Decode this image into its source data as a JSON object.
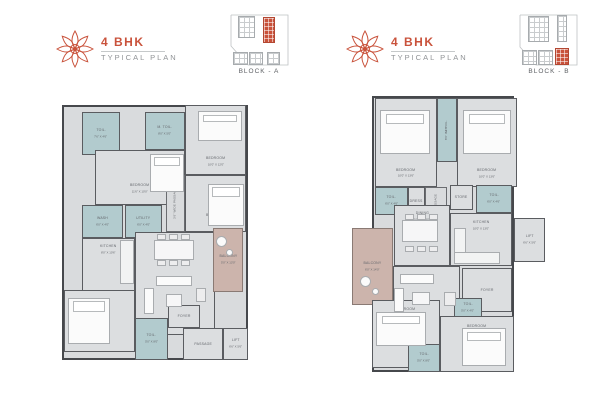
{
  "colors": {
    "accent": "#c9523b",
    "wall": "#46484c",
    "floor": "#d9dbdd",
    "toilet": "#b2cbce",
    "balcony": "#ccb4ac",
    "label": "#63666b"
  },
  "headers": [
    {
      "title": "4 BHK",
      "subtitle": "TYPICAL PLAN",
      "block_label": "BLOCK - A"
    },
    {
      "title": "4 BHK",
      "subtitle": "TYPICAL PLAN",
      "block_label": "BLOCK - B"
    }
  ],
  "keyplans": [
    {
      "outline_points": "3,1 60,1 60,51 20,51 3,32 3,1",
      "buildings": [
        {
          "x": 10,
          "y": 2,
          "w": 17,
          "h": 22,
          "hl": false
        },
        {
          "x": 35,
          "y": 3,
          "w": 12,
          "h": 26,
          "hl": true
        },
        {
          "x": 5,
          "y": 38,
          "w": 15,
          "h": 13,
          "hl": false
        },
        {
          "x": 21,
          "y": 38,
          "w": 14,
          "h": 13,
          "hl": false
        },
        {
          "x": 39,
          "y": 38,
          "w": 13,
          "h": 13,
          "hl": false
        }
      ]
    },
    {
      "outline_points": "2,1 59,1 59,51 18,51 2,33 2,1",
      "buildings": [
        {
          "x": 10,
          "y": 2,
          "w": 21,
          "h": 26,
          "hl": false
        },
        {
          "x": 39,
          "y": 1,
          "w": 10,
          "h": 27,
          "hl": false
        },
        {
          "x": 4,
          "y": 36,
          "w": 15,
          "h": 15,
          "hl": false
        },
        {
          "x": 20,
          "y": 36,
          "w": 15,
          "h": 15,
          "hl": false
        },
        {
          "x": 37,
          "y": 34,
          "w": 14,
          "h": 17,
          "hl": true
        }
      ]
    }
  ],
  "plans": [
    {
      "name": "block-a-unit-plan",
      "outline": {
        "x": 4,
        "y": 13,
        "w": 186,
        "h": 255
      },
      "rooms": [
        {
          "label": "TOIL.",
          "dim": "7'6\" X 4'6\"",
          "type": "toilet",
          "x": 24,
          "y": 20,
          "w": 38,
          "h": 43
        },
        {
          "label": "M. TOIL.",
          "dim": "8'0\" X 5'0\"",
          "type": "toilet",
          "x": 87,
          "y": 20,
          "w": 40,
          "h": 38
        },
        {
          "label": "BEDROOM",
          "dim": "11'6\" X 10'0\"",
          "x": 37,
          "y": 58,
          "w": 90,
          "h": 55,
          "va": "bottom"
        },
        {
          "label": "BEDROOM",
          "dim": "10'0\" X 12'0\"",
          "x": 127,
          "y": 13,
          "w": 61,
          "h": 70,
          "va": "bottom"
        },
        {
          "label": "BEDROOM",
          "dim": "10'0\" X 11'6\"",
          "x": 127,
          "y": 83,
          "w": 61,
          "h": 57,
          "va": "bottom"
        },
        {
          "label": "3'6\" WIDE PASSAGE",
          "type": "corridor",
          "vert": true,
          "x": 108,
          "y": 83,
          "w": 19,
          "h": 57
        },
        {
          "label": "WASH",
          "dim": "6'0\" X 4'0\"",
          "type": "toilet",
          "x": 24,
          "y": 113,
          "w": 41,
          "h": 33
        },
        {
          "label": "UTILITY",
          "dim": "6'0\" X 4'0\"",
          "type": "toilet",
          "x": 67,
          "y": 113,
          "w": 37,
          "h": 33
        },
        {
          "label": "KITCHEN",
          "dim": "8'0\" X 10'6\"",
          "x": 24,
          "y": 146,
          "w": 53,
          "h": 57,
          "va": "top"
        },
        {
          "label": "DINE / LIVING",
          "dim": "13'0\" X 22'0\"",
          "x": 77,
          "y": 140,
          "w": 80,
          "h": 103,
          "va": "top"
        },
        {
          "label": "BALCONY",
          "dim": "5'0\" X 13'0\"",
          "type": "balcony",
          "x": 155,
          "y": 136,
          "w": 30,
          "h": 64
        },
        {
          "label": "BEDROOM",
          "dim": "10'0\" X 11'6\"",
          "x": 6,
          "y": 198,
          "w": 71,
          "h": 62
        },
        {
          "label": "TOIL.",
          "dim": "5'0\" X 8'0\"",
          "type": "toilet",
          "x": 77,
          "y": 226,
          "w": 33,
          "h": 42
        },
        {
          "label": "FOYER",
          "x": 110,
          "y": 213,
          "w": 32,
          "h": 23
        },
        {
          "label": "PASSAGE",
          "x": 125,
          "y": 236,
          "w": 40,
          "h": 32
        },
        {
          "label": "LIFT",
          "dim": "6'6\" X 5'6\"",
          "x": 165,
          "y": 236,
          "w": 25,
          "h": 32
        }
      ],
      "furniture": [
        {
          "type": "bed",
          "x": 92,
          "y": 62,
          "w": 34,
          "h": 38
        },
        {
          "type": "bed",
          "x": 140,
          "y": 19,
          "w": 44,
          "h": 30
        },
        {
          "type": "bed",
          "x": 150,
          "y": 92,
          "w": 36,
          "h": 42
        },
        {
          "type": "bed",
          "x": 10,
          "y": 206,
          "w": 42,
          "h": 46
        },
        {
          "type": "table",
          "x": 96,
          "y": 148,
          "w": 40,
          "h": 20
        },
        {
          "type": "chair",
          "x": 99,
          "y": 142,
          "w": 9,
          "h": 6
        },
        {
          "type": "chair",
          "x": 111,
          "y": 142,
          "w": 9,
          "h": 6
        },
        {
          "type": "chair",
          "x": 123,
          "y": 142,
          "w": 9,
          "h": 6
        },
        {
          "type": "chair",
          "x": 99,
          "y": 168,
          "w": 9,
          "h": 6
        },
        {
          "type": "chair",
          "x": 111,
          "y": 168,
          "w": 9,
          "h": 6
        },
        {
          "type": "chair",
          "x": 123,
          "y": 168,
          "w": 9,
          "h": 6
        },
        {
          "type": "sofa",
          "x": 98,
          "y": 184,
          "w": 36,
          "h": 10
        },
        {
          "type": "sofa",
          "x": 86,
          "y": 196,
          "w": 10,
          "h": 26
        },
        {
          "type": "chair",
          "x": 138,
          "y": 196,
          "w": 10,
          "h": 14
        },
        {
          "type": "table",
          "x": 108,
          "y": 202,
          "w": 16,
          "h": 13
        },
        {
          "type": "counter",
          "x": 62,
          "y": 148,
          "w": 14,
          "h": 44
        },
        {
          "type": "plant",
          "x": 158,
          "y": 144,
          "w": 11,
          "h": 11
        },
        {
          "type": "plant",
          "x": 168,
          "y": 157,
          "w": 7,
          "h": 7
        }
      ]
    },
    {
      "name": "block-b-unit-plan",
      "outline": {
        "x": 24,
        "y": 8,
        "w": 142,
        "h": 276
      },
      "rooms": [
        {
          "label": "BEDROOM",
          "dim": "10'0\" X 13'6\"",
          "x": 27,
          "y": 10,
          "w": 62,
          "h": 89,
          "va": "bottom"
        },
        {
          "label": "M. TOIL.",
          "dim": "8'6\" X 4'6\"",
          "type": "toilet",
          "vert": true,
          "x": 89,
          "y": 10,
          "w": 20,
          "h": 64
        },
        {
          "label": "BEDROOM",
          "dim": "10'0\" X 13'6\"",
          "x": 109,
          "y": 10,
          "w": 60,
          "h": 89,
          "va": "bottom"
        },
        {
          "label": "TOIL.",
          "dim": "6'0\" X 4'6\"",
          "type": "toilet",
          "x": 27,
          "y": 99,
          "w": 33,
          "h": 28
        },
        {
          "label": "DRESS",
          "x": 60,
          "y": 99,
          "w": 17,
          "h": 28
        },
        {
          "label": "PASSAGE",
          "type": "corridor",
          "vert": true,
          "x": 77,
          "y": 99,
          "w": 22,
          "h": 28
        },
        {
          "label": "STORE",
          "x": 102,
          "y": 97,
          "w": 23,
          "h": 25
        },
        {
          "label": "TOIL.",
          "dim": "6'0\" X 4'6\"",
          "type": "toilet",
          "x": 128,
          "y": 97,
          "w": 36,
          "h": 28
        },
        {
          "label": "DINING",
          "dim": "10'0\" X 13'0\"",
          "x": 46,
          "y": 117,
          "w": 56,
          "h": 61,
          "va": "top"
        },
        {
          "label": "KITCHEN",
          "dim": "10'0\" X 13'0\"",
          "x": 102,
          "y": 125,
          "w": 62,
          "h": 53,
          "va": "top"
        },
        {
          "label": "BALCONY",
          "dim": "6'0\" X 14'0\"",
          "type": "balcony",
          "x": 4,
          "y": 140,
          "w": 41,
          "h": 77
        },
        {
          "label": "LIVING",
          "dim": "13'0\" X 11'0\"",
          "x": 45,
          "y": 178,
          "w": 67,
          "h": 59,
          "va": "bottom"
        },
        {
          "label": "LIFT",
          "dim": "6'6\" X 5'6\"",
          "x": 166,
          "y": 130,
          "w": 31,
          "h": 44
        },
        {
          "label": "FOYER",
          "x": 114,
          "y": 180,
          "w": 50,
          "h": 44
        },
        {
          "label": "BEDROOM",
          "dim": "10'0\" X 11'6\"",
          "x": 24,
          "y": 212,
          "w": 68,
          "h": 68,
          "va": "top"
        },
        {
          "label": "TOIL.",
          "dim": "5'0\" X 8'0\"",
          "type": "toilet",
          "x": 60,
          "y": 256,
          "w": 32,
          "h": 28
        },
        {
          "label": "TOIL.",
          "dim": "5'0\" X 4'0\"",
          "type": "toilet",
          "x": 106,
          "y": 210,
          "w": 28,
          "h": 20
        },
        {
          "label": "BEDROOM",
          "dim": "11'0\" X 10'0\"",
          "x": 92,
          "y": 228,
          "w": 74,
          "h": 56,
          "va": "top"
        }
      ],
      "furniture": [
        {
          "type": "bed",
          "x": 32,
          "y": 22,
          "w": 50,
          "h": 44
        },
        {
          "type": "bed",
          "x": 115,
          "y": 22,
          "w": 48,
          "h": 44
        },
        {
          "type": "table",
          "x": 54,
          "y": 132,
          "w": 36,
          "h": 22
        },
        {
          "type": "chair",
          "x": 57,
          "y": 126,
          "w": 9,
          "h": 6
        },
        {
          "type": "chair",
          "x": 69,
          "y": 126,
          "w": 9,
          "h": 6
        },
        {
          "type": "chair",
          "x": 81,
          "y": 126,
          "w": 9,
          "h": 6
        },
        {
          "type": "chair",
          "x": 57,
          "y": 158,
          "w": 9,
          "h": 6
        },
        {
          "type": "chair",
          "x": 69,
          "y": 158,
          "w": 9,
          "h": 6
        },
        {
          "type": "chair",
          "x": 81,
          "y": 158,
          "w": 9,
          "h": 6
        },
        {
          "type": "counter",
          "x": 106,
          "y": 140,
          "w": 12,
          "h": 36
        },
        {
          "type": "counter",
          "x": 106,
          "y": 164,
          "w": 46,
          "h": 12
        },
        {
          "type": "sofa",
          "x": 52,
          "y": 186,
          "w": 34,
          "h": 10
        },
        {
          "type": "sofa",
          "x": 46,
          "y": 200,
          "w": 10,
          "h": 24
        },
        {
          "type": "chair",
          "x": 96,
          "y": 204,
          "w": 12,
          "h": 14
        },
        {
          "type": "table",
          "x": 64,
          "y": 204,
          "w": 18,
          "h": 13
        },
        {
          "type": "plant",
          "x": 12,
          "y": 188,
          "w": 11,
          "h": 11
        },
        {
          "type": "plant",
          "x": 24,
          "y": 200,
          "w": 7,
          "h": 7
        },
        {
          "type": "bed",
          "x": 28,
          "y": 224,
          "w": 50,
          "h": 34
        },
        {
          "type": "bed",
          "x": 114,
          "y": 240,
          "w": 44,
          "h": 38
        }
      ]
    }
  ]
}
